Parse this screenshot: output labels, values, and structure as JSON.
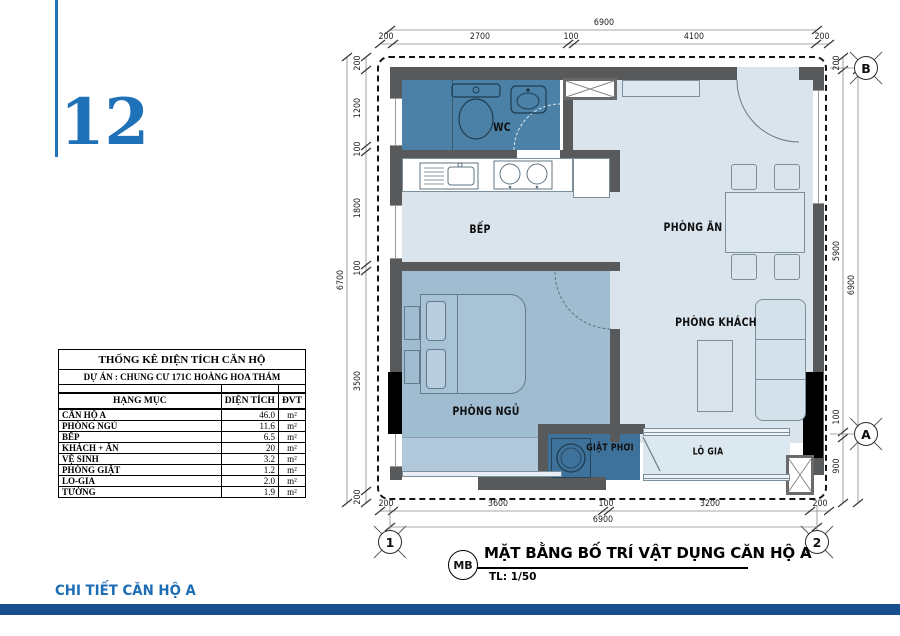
{
  "sheet": {
    "number": "12",
    "footer_label": "CHI TIẾT CĂN HỘ A"
  },
  "title_block": {
    "tag": "MB",
    "title": "MẶT BẰNG BỐ TRÍ VẬT DỤNG CĂN HỘ A",
    "scale": "TL: 1/50"
  },
  "area_table": {
    "title": "THỐNG KÊ DIỆN TÍCH CĂN HỘ",
    "subtitle": "DỰ ÁN : CHUNG CƯ 171C HOÀNG HOA THÁM",
    "columns": [
      "HẠNG MỤC",
      "DIỆN TÍCH",
      "ĐVT"
    ],
    "rows": [
      {
        "item": "CĂN HỘ A",
        "area": "46.0",
        "unit": "m²"
      },
      {
        "item": "PHÒNG NGỦ",
        "area": "11.6",
        "unit": "m²"
      },
      {
        "item": "BẾP",
        "area": "6.5",
        "unit": "m²"
      },
      {
        "item": "KHÁCH + ĂN",
        "area": "20",
        "unit": "m²"
      },
      {
        "item": "VỆ SINH",
        "area": "3.2",
        "unit": "m²"
      },
      {
        "item": "PHÒNG GIẶT",
        "area": "1.2",
        "unit": "m²"
      },
      {
        "item": "LO-GIA",
        "area": "2.0",
        "unit": "m²"
      },
      {
        "item": "TƯỜNG",
        "area": "1.9",
        "unit": "m²"
      }
    ]
  },
  "plan": {
    "rooms": [
      {
        "id": "wc",
        "label": "WC"
      },
      {
        "id": "bep",
        "label": "BẾP"
      },
      {
        "id": "phong-an",
        "label": "PHÒNG ĂN"
      },
      {
        "id": "phong-khach",
        "label": "PHÒNG KHÁCH"
      },
      {
        "id": "phong-ngu",
        "label": "PHÒNG NGỦ"
      },
      {
        "id": "giat-phoi",
        "label": "GIẶT PHƠI"
      },
      {
        "id": "lo-gia",
        "label": "LÔ GIA"
      }
    ],
    "grid_markers": {
      "c1": "1",
      "c2": "2",
      "a": "A",
      "b": "B"
    },
    "dimensions": {
      "top": {
        "overall": "6900",
        "segments": [
          "200",
          "2700",
          "100",
          "4100",
          "200"
        ]
      },
      "bottom": {
        "overall": "6900",
        "segments": [
          "200",
          "3600",
          "100",
          "3200",
          "200"
        ]
      },
      "left": {
        "overall": "6700",
        "segments": [
          "200",
          "1200",
          "100",
          "1800",
          "100",
          "3500",
          "200"
        ]
      },
      "right": {
        "overall": "6900",
        "segments": [
          "200",
          "5900",
          "100",
          "900"
        ]
      }
    }
  },
  "colors": {
    "accent_blue": "#1f72b8",
    "footer_bar": "#17508c",
    "wall_gray": "#58595b",
    "room_light": "#d9e4ec",
    "room_medium": "#9fbcd1",
    "room_dark_wc": "#4b81a6",
    "room_dark_laundry": "#3f729b",
    "column_black": "#000000"
  }
}
